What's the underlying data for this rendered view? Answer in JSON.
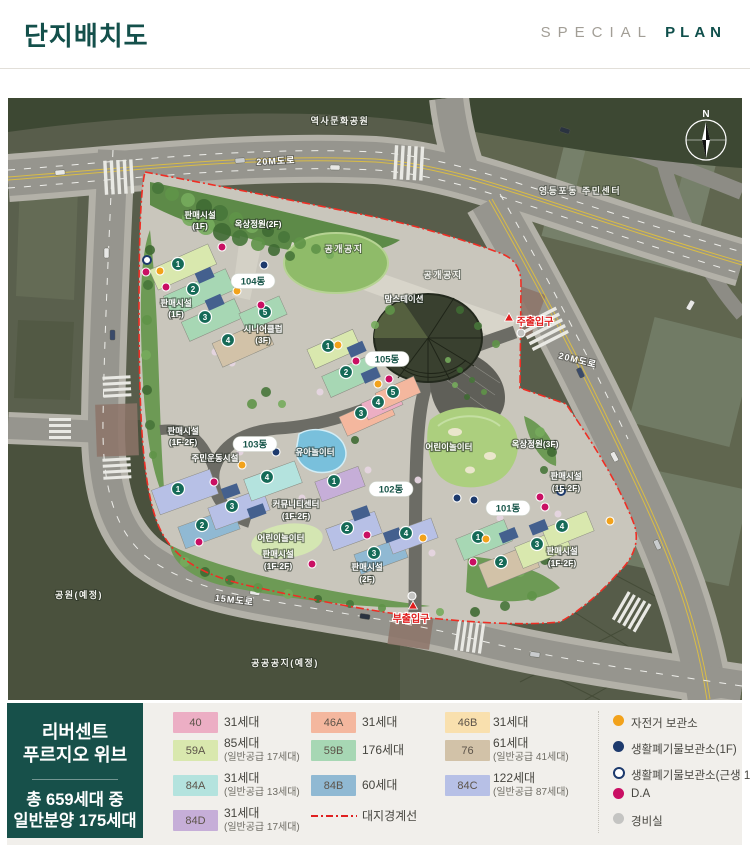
{
  "header": {
    "title": "단지배치도",
    "brand_light": "SPECIAL",
    "brand_bold": "PLAN"
  },
  "map": {
    "building_numbers": [
      "1",
      "2",
      "3",
      "4",
      "5"
    ],
    "labels": {
      "history_park": "역사문화공원",
      "road_20m_top": "20M도로",
      "road_20m_right": "20M도로",
      "road_15m": "15M도로",
      "community_center_area": "영등포동 주민센터",
      "open_space_1": "공개공지",
      "open_space_2": "공개공지",
      "mom_station": "맘스테이션",
      "sales_top": [
        "판매시설",
        "(1F)"
      ],
      "sales_left": [
        "판매시설",
        "(1F)"
      ],
      "sales_mid_left": [
        "판매시설",
        "(1F·2F)"
      ],
      "sales_bottom_center": [
        "판매시설",
        "(1F·2F)"
      ],
      "sales_bottom_right": [
        "판매시설",
        "(2F)"
      ],
      "sales_right_top": [
        "판매시설",
        "(1F·2F)"
      ],
      "sales_right_bottom": [
        "판매시설",
        "(1F·2F)"
      ],
      "roof_garden_2f": "옥상정원(2F)",
      "roof_garden_3f": "옥상정원(3F)",
      "senior_club": [
        "시니어클럽",
        "(3F)"
      ],
      "community_sports": "주민운동시설",
      "community_center_bldg": [
        "커뮤니티센터",
        "(1F·2F)"
      ],
      "toddler_play": "유아놀이터",
      "kids_play_right": "어린이놀이터",
      "kids_play_center": "어린이놀이터",
      "park_planned": "공원(예정)",
      "public_site_planned": "공공공지(예정)",
      "main_entrance": "주출입구",
      "sub_entrance": "부출입구",
      "compass_n": "N",
      "dong_101": "101동",
      "dong_102": "102동",
      "dong_103": "103동",
      "dong_104": "104동",
      "dong_105": "105동"
    },
    "markers": [
      {
        "t": "bike",
        "x": 160,
        "y": 271
      },
      {
        "t": "bike",
        "x": 237,
        "y": 291
      },
      {
        "t": "bike",
        "x": 338,
        "y": 345
      },
      {
        "t": "bike",
        "x": 378,
        "y": 384
      },
      {
        "t": "bike",
        "x": 242,
        "y": 465
      },
      {
        "t": "bike",
        "x": 423,
        "y": 538
      },
      {
        "t": "bike",
        "x": 486,
        "y": 539
      },
      {
        "t": "bike",
        "x": 610,
        "y": 521
      },
      {
        "t": "da",
        "x": 146,
        "y": 272
      },
      {
        "t": "da",
        "x": 166,
        "y": 287
      },
      {
        "t": "da",
        "x": 222,
        "y": 247
      },
      {
        "t": "da",
        "x": 261,
        "y": 305
      },
      {
        "t": "da",
        "x": 356,
        "y": 361
      },
      {
        "t": "da",
        "x": 389,
        "y": 379
      },
      {
        "t": "da",
        "x": 214,
        "y": 482
      },
      {
        "t": "da",
        "x": 199,
        "y": 542
      },
      {
        "t": "da",
        "x": 312,
        "y": 564
      },
      {
        "t": "da",
        "x": 367,
        "y": 535
      },
      {
        "t": "da",
        "x": 540,
        "y": 497
      },
      {
        "t": "da",
        "x": 545,
        "y": 507
      },
      {
        "t": "da",
        "x": 473,
        "y": 562
      },
      {
        "t": "waste",
        "x": 264,
        "y": 265
      },
      {
        "t": "waste",
        "x": 276,
        "y": 452
      },
      {
        "t": "waste",
        "x": 457,
        "y": 498
      },
      {
        "t": "waste",
        "x": 474,
        "y": 500
      },
      {
        "t": "waste_ring",
        "x": 147,
        "y": 260
      },
      {
        "t": "waste_ring",
        "x": 561,
        "y": 491
      },
      {
        "t": "guard",
        "x": 521,
        "y": 333
      },
      {
        "t": "guard",
        "x": 412,
        "y": 596
      }
    ]
  },
  "legend": {
    "project": {
      "name_line1": "리버센트",
      "name_line2": "푸르지오 위브",
      "total_line1": "총 659세대 중",
      "total_line2": "일반분양 175세대"
    },
    "colors": {
      "u40": "#ecaec4",
      "u46A": "#f4b79e",
      "u46B": "#f9e0ae",
      "u59A": "#d9e8ae",
      "u59B": "#a7d7b4",
      "u76": "#d2c2a8",
      "u84A": "#b4e3de",
      "u84B": "#90b9d3",
      "u84C": "#b7c0e6",
      "u84D": "#c6aed8"
    },
    "units": [
      {
        "code": "40",
        "count": "31세대",
        "sub": ""
      },
      {
        "code": "59A",
        "count": "85세대",
        "sub": "(일반공급 17세대)"
      },
      {
        "code": "84A",
        "count": "31세대",
        "sub": "(일반공급 13세대)"
      },
      {
        "code": "84D",
        "count": "31세대",
        "sub": "(일반공급 17세대)"
      },
      {
        "code": "46A",
        "count": "31세대",
        "sub": ""
      },
      {
        "code": "59B",
        "count": "176세대",
        "sub": ""
      },
      {
        "code": "84B",
        "count": "60세대",
        "sub": ""
      },
      {
        "code": "46B",
        "count": "31세대",
        "sub": ""
      },
      {
        "code": "76",
        "count": "61세대",
        "sub": "(일반공급 41세대)"
      },
      {
        "code": "84C",
        "count": "122세대",
        "sub": "(일반공급 87세대)"
      }
    ],
    "boundary": {
      "label": "대지경계선",
      "color": "#e02020"
    },
    "marker_colors": {
      "bike": "#f2a21b",
      "waste": "#1d3a6d",
      "da": "#c90f63",
      "guard": "#c4c4c2"
    },
    "marker_items": [
      {
        "type": "bike",
        "label": "자전거 보관소"
      },
      {
        "type": "waste",
        "label": "생활폐기물보관소(1F)"
      },
      {
        "type": "waste_ring",
        "label": "생활폐기물보관소(근생 1F)"
      },
      {
        "type": "da",
        "label": "D.A"
      },
      {
        "type": "guard",
        "label": "경비실"
      }
    ]
  }
}
